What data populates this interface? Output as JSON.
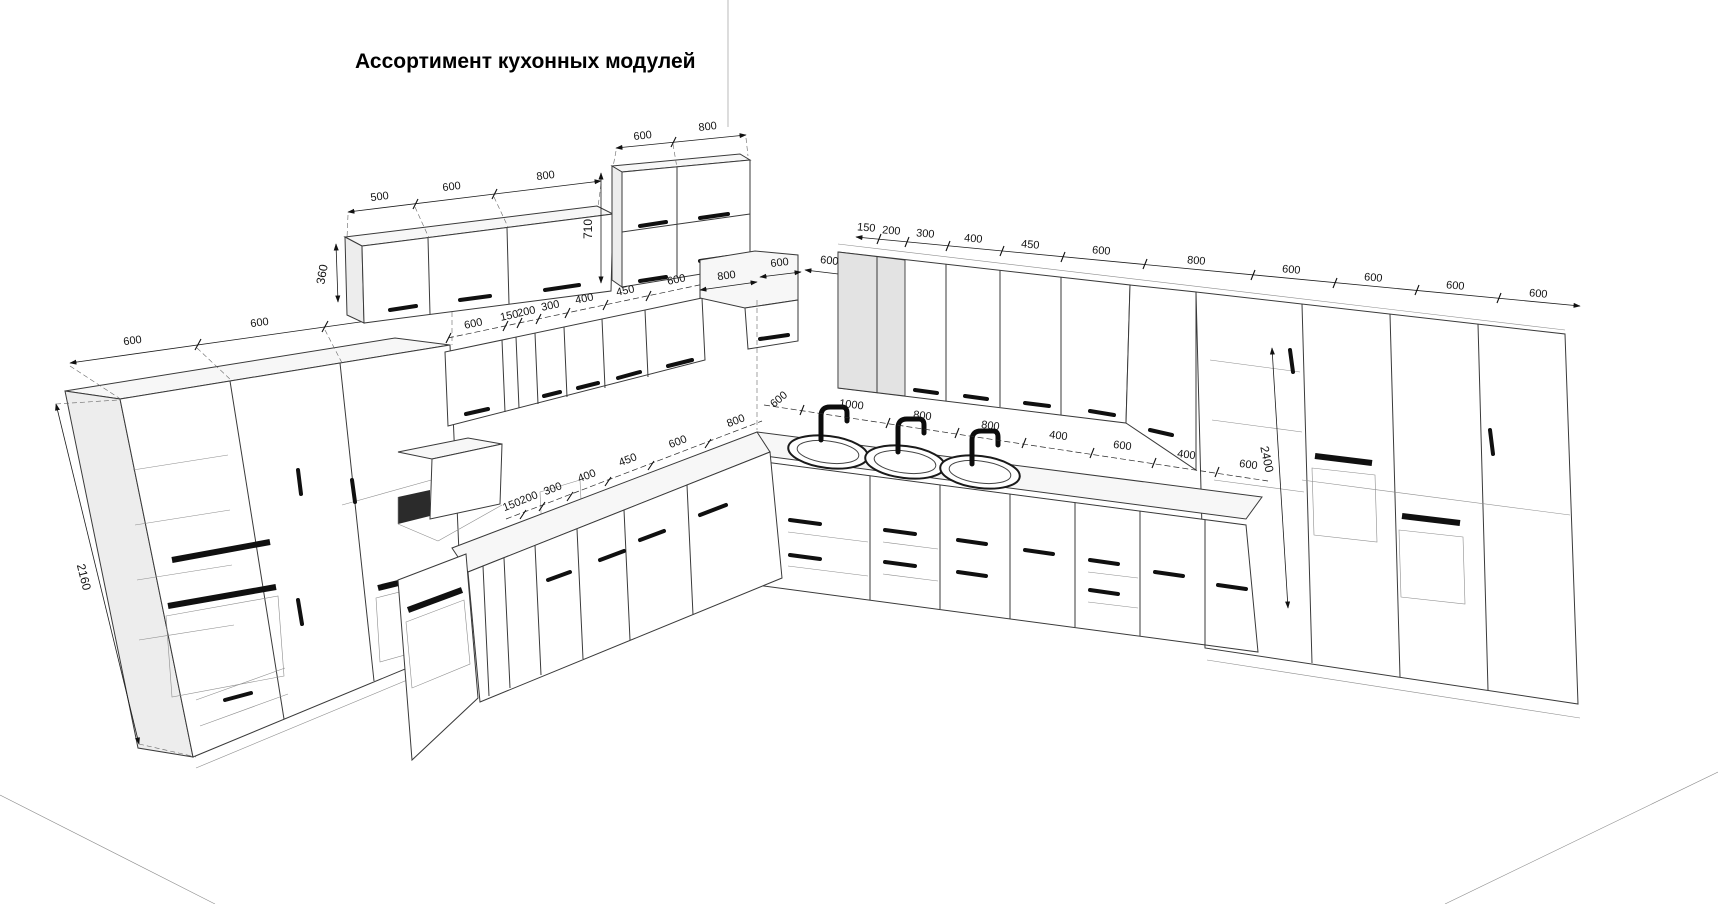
{
  "title": "Ассортимент кухонных модулей",
  "dims": {
    "left_tall": {
      "widths": [
        "600",
        "600",
        "600"
      ],
      "height": "2160"
    },
    "wall_set_a": {
      "widths": [
        "500",
        "600",
        "800"
      ],
      "height": "360"
    },
    "wall_set_b": {
      "widths": [
        "600",
        "800"
      ],
      "height": "710"
    },
    "mid_wall": {
      "widths": [
        "600",
        "150",
        "200",
        "300",
        "400",
        "450",
        "600"
      ]
    },
    "corner_wall": {
      "widths": [
        "800",
        "600",
        "600"
      ]
    },
    "right_wall": {
      "widths": [
        "150",
        "200",
        "300",
        "400",
        "450",
        "600",
        "800",
        "600",
        "600",
        "600",
        "600"
      ]
    },
    "mid_base": {
      "widths": [
        "150",
        "200",
        "300",
        "400",
        "450",
        "600",
        "800"
      ]
    },
    "right_base": {
      "widths": [
        "600",
        "1000",
        "800",
        "800",
        "400",
        "600",
        "400",
        "600"
      ]
    },
    "right_tall": {
      "height": "2400"
    }
  }
}
